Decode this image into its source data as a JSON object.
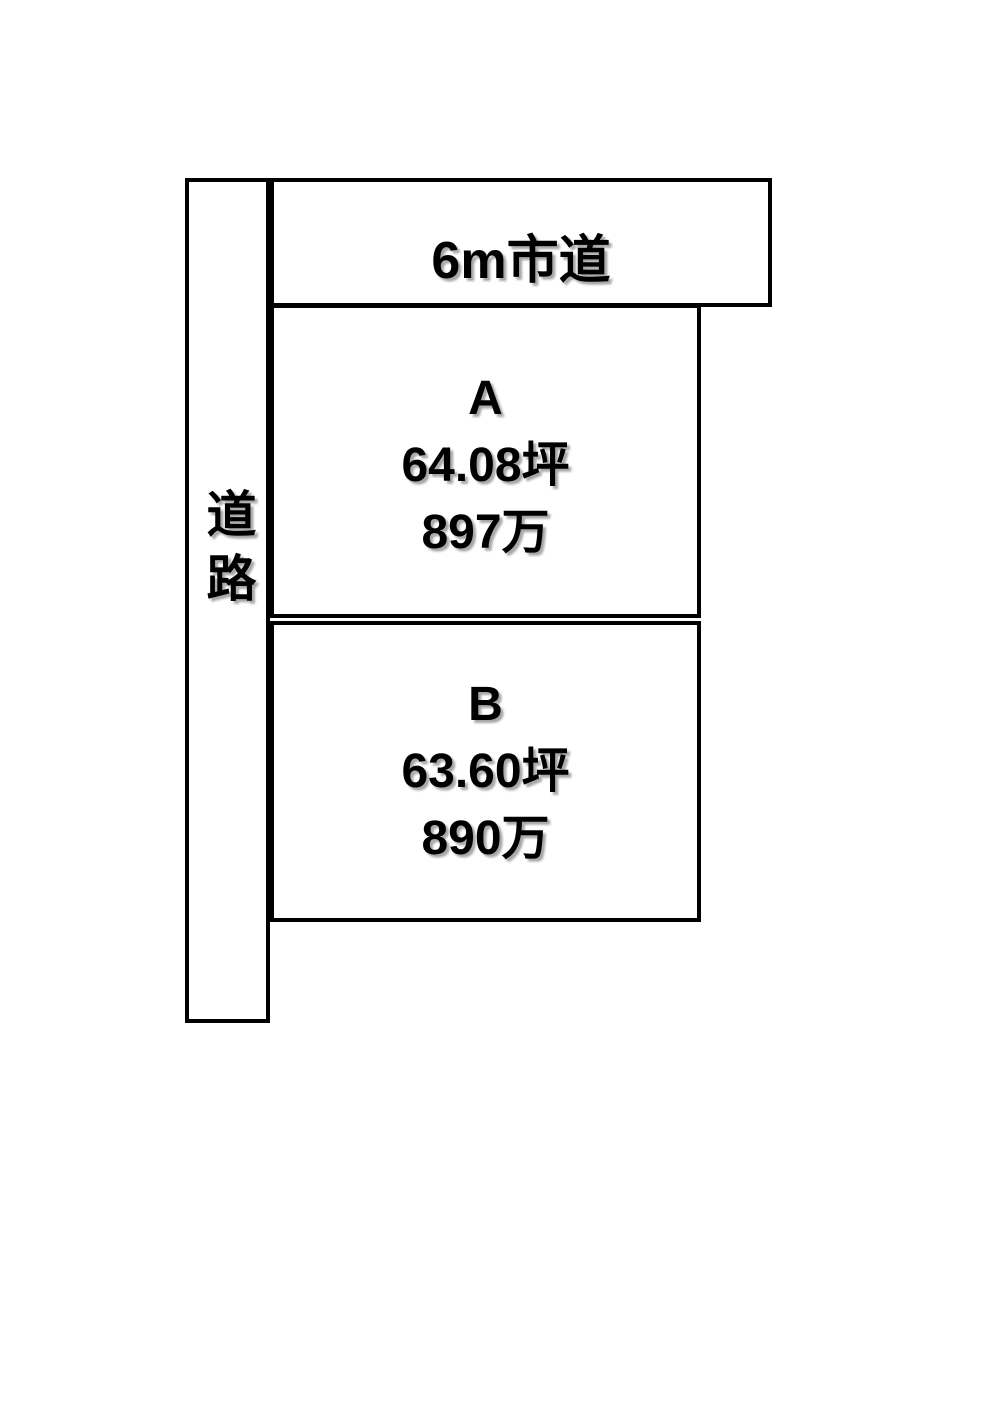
{
  "diagram": {
    "title": "land-plot-layout",
    "background_color": "#ffffff",
    "line_color": "#000000",
    "road_left": {
      "label": "道路"
    },
    "road_top": {
      "label": "6m市道"
    },
    "plots": [
      {
        "id": "A",
        "area": "64.08坪",
        "price": "897万"
      },
      {
        "id": "B",
        "area": "63.60坪",
        "price": "890万"
      }
    ]
  }
}
